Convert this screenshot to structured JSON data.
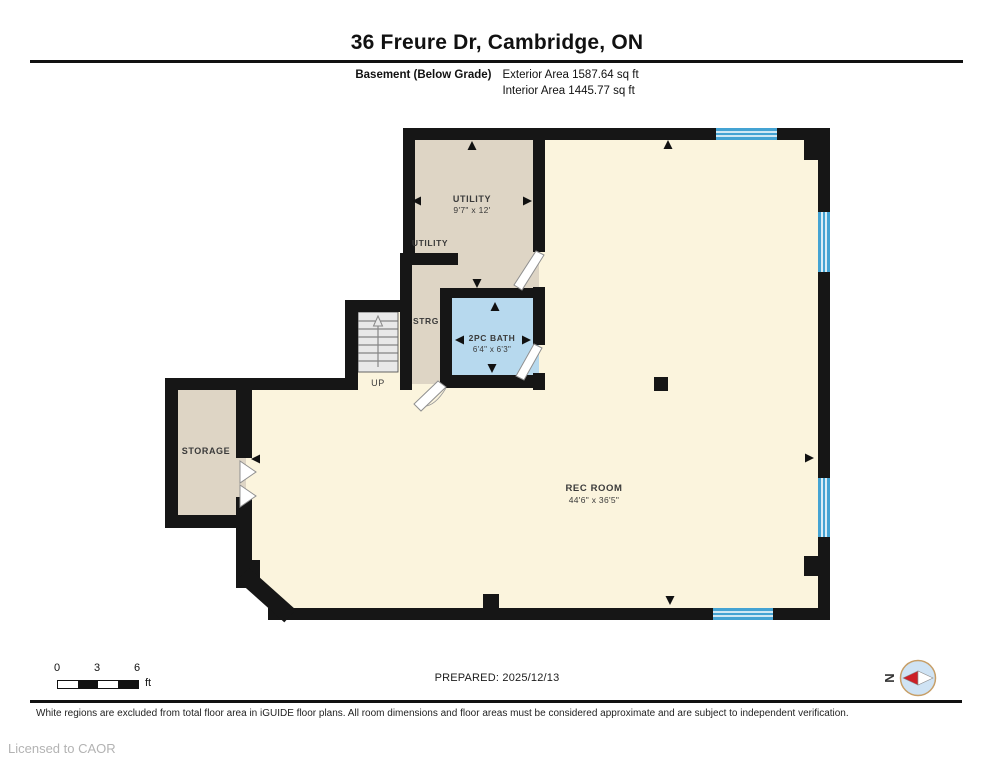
{
  "header": {
    "title": "36 Freure Dr, Cambridge, ON",
    "floor_label": "Basement (Below Grade)",
    "exterior_area": "Exterior Area 1587.64 sq ft",
    "interior_area": "Interior Area 1445.77 sq ft"
  },
  "plan": {
    "colors": {
      "wall": "#161616",
      "rec_room": "#FBF4DD",
      "utility": "#DED5C5",
      "bath": "#B7D9EE",
      "window": "#44A3D3",
      "stairs": "#E9E9E9"
    },
    "rooms": {
      "utility": {
        "name": "UTILITY",
        "dims": "9'7\" x 12'"
      },
      "utility_area": {
        "name": "UTILITY"
      },
      "strg": {
        "name": "STRG"
      },
      "bath": {
        "name": "2PC BATH",
        "dims": "6'4\" x 6'3\""
      },
      "storage": {
        "name": "STORAGE"
      },
      "rec_room": {
        "name": "REC ROOM",
        "dims": "44'6\" x 36'5\""
      }
    },
    "stairs_label": "UP"
  },
  "footer": {
    "scale": {
      "ticks": [
        "0",
        "3",
        "6"
      ],
      "unit": "ft"
    },
    "prepared": "PREPARED: 2025/12/13",
    "compass": {
      "label": "N",
      "circle_color": "#CFE3F4"
    },
    "disclaimer": "White regions are excluded from total floor area in iGUIDE floor plans. All room dimensions and floor areas must be considered approximate and are subject to independent verification.",
    "license": "Licensed to CAOR"
  }
}
